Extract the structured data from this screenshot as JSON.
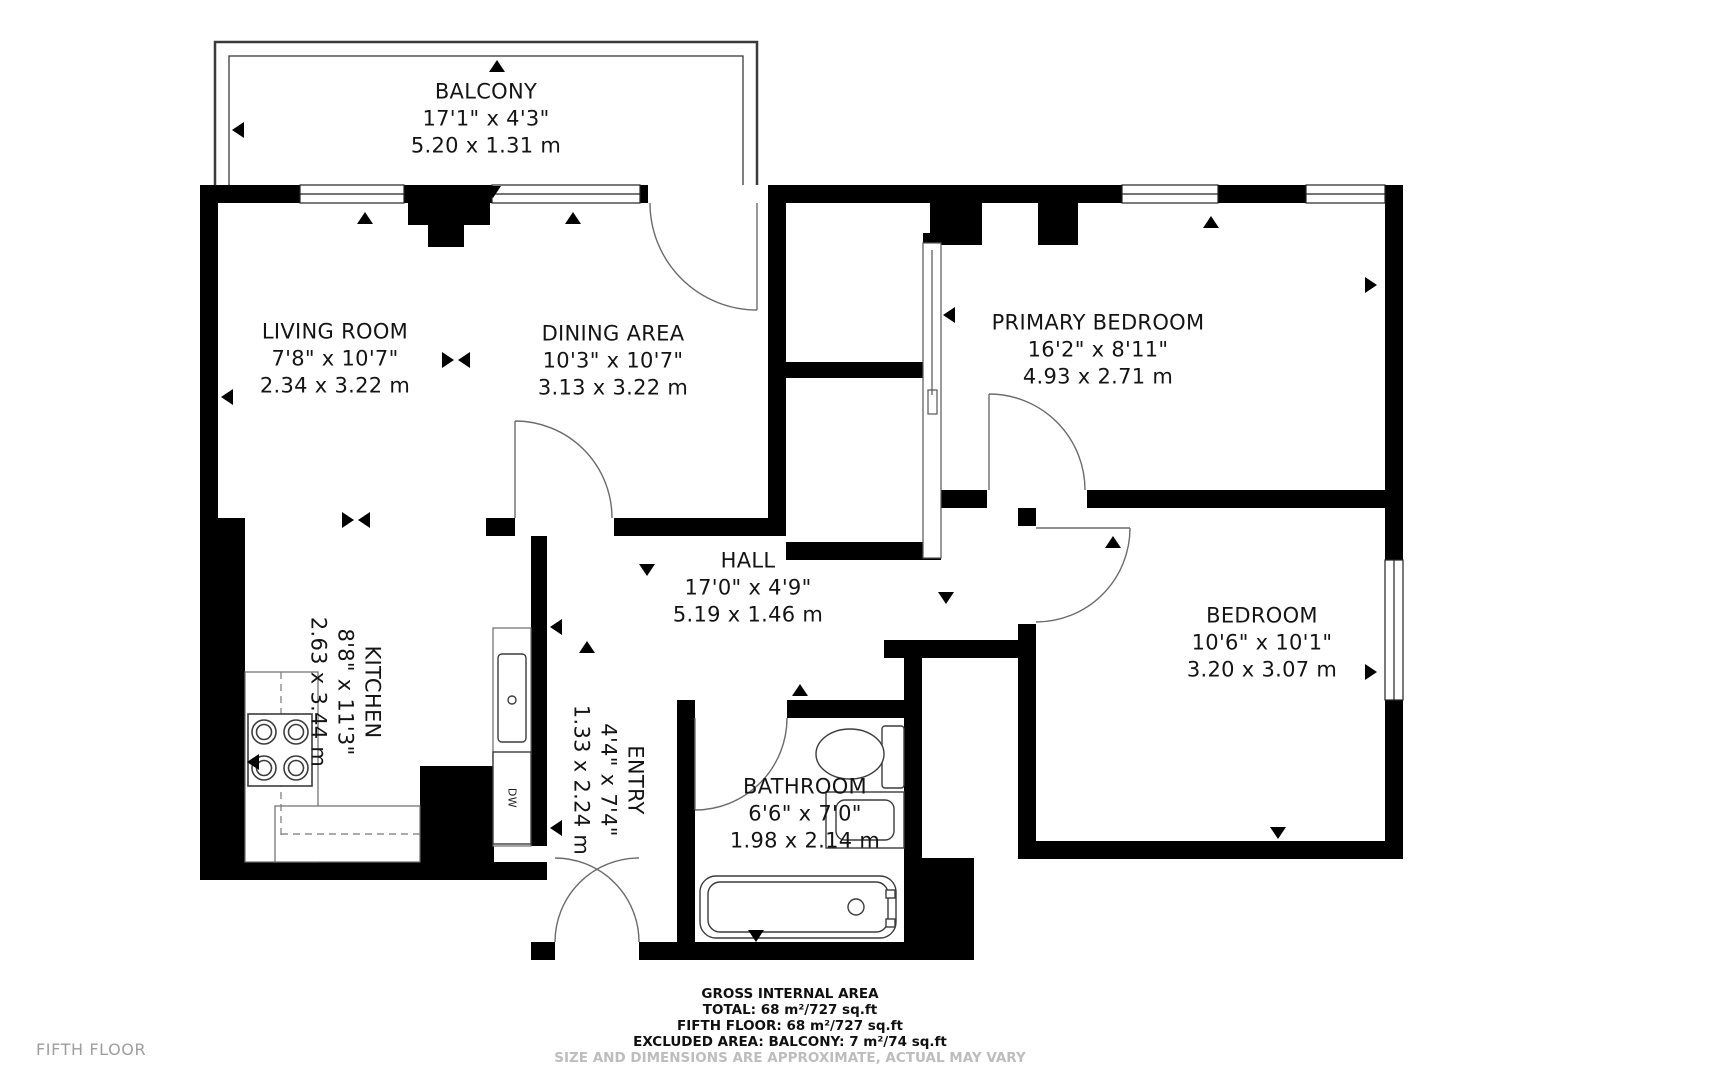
{
  "floor_plan": {
    "title": "FIFTH FLOOR",
    "rooms": [
      {
        "id": "balcony",
        "name": "BALCONY",
        "imperial": "17'1\" x 4'3\"",
        "metric": "5.20 x 1.31 m"
      },
      {
        "id": "living",
        "name": "LIVING ROOM",
        "imperial": "7'8\" x 10'7\"",
        "metric": "2.34 x 3.22 m"
      },
      {
        "id": "dining",
        "name": "DINING AREA",
        "imperial": "10'3\" x 10'7\"",
        "metric": "3.13 x 3.22 m"
      },
      {
        "id": "primary",
        "name": "PRIMARY BEDROOM",
        "imperial": "16'2\" x 8'11\"",
        "metric": "4.93 x 2.71 m"
      },
      {
        "id": "hall",
        "name": "HALL",
        "imperial": "17'0\" x 4'9\"",
        "metric": "5.19 x 1.46 m"
      },
      {
        "id": "kitchen",
        "name": "KITCHEN",
        "imperial": "8'8\" x 11'3\"",
        "metric": "2.63 x 3.44 m"
      },
      {
        "id": "entry",
        "name": "ENTRY",
        "imperial": "4'4\" x 7'4\"",
        "metric": "1.33 x 2.24 m"
      },
      {
        "id": "bathroom",
        "name": "BATHROOM",
        "imperial": "6'6\" x 7'0\"",
        "metric": "1.98 x 2.14 m"
      },
      {
        "id": "bedroom",
        "name": "BEDROOM",
        "imperial": "10'6\" x 10'1\"",
        "metric": "3.20 x 3.07 m"
      }
    ],
    "fixtures": {
      "dishwasher_label": "DW"
    },
    "footer": {
      "heading": "GROSS INTERNAL AREA",
      "total": "TOTAL: 68 m²/727 sq.ft",
      "floor": "FIFTH FLOOR: 68 m²/727 sq.ft",
      "excluded": "EXCLUDED AREA: BALCONY: 7 m²/74 sq.ft",
      "disclaimer": "SIZE AND DIMENSIONS ARE APPROXIMATE, ACTUAL MAY VARY"
    },
    "colors": {
      "wall": "#000000",
      "fixture_line": "#3c3c3c",
      "door_arc": "#6b6b6b",
      "muted_text": "#9e9e9e"
    }
  }
}
